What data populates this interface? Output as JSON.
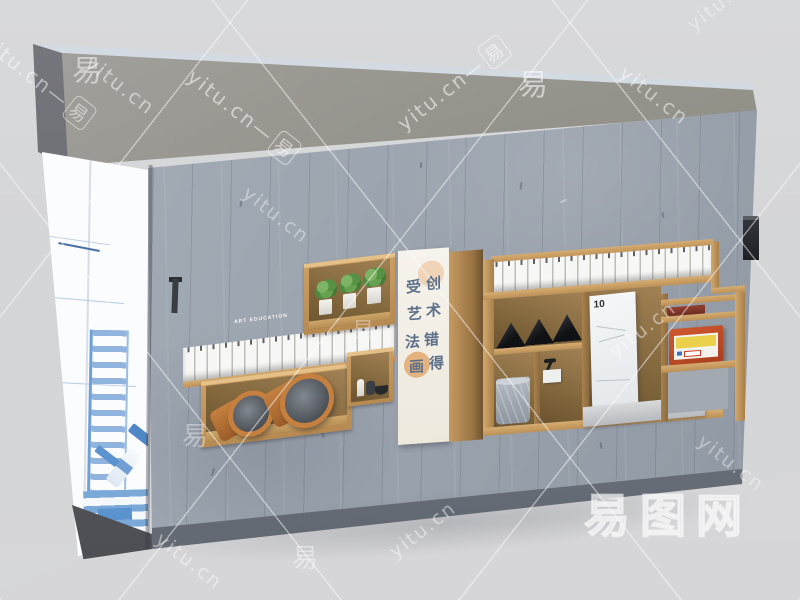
{
  "watermark": {
    "site": "yitu.cn",
    "char": "易",
    "dash": "—",
    "logo": "易图网",
    "tiles": [
      {
        "t": "combo",
        "x": -15,
        "y": 25,
        "rot": 38,
        "s": 20,
        "o": 0.5
      },
      {
        "t": "site",
        "x": 88,
        "y": 48,
        "rot": 38,
        "s": 20,
        "o": 0.5
      },
      {
        "t": "combo",
        "x": 190,
        "y": 60,
        "rot": 38,
        "s": 20,
        "o": 0.55
      },
      {
        "t": "combo",
        "x": 400,
        "y": 112,
        "rot": -38,
        "s": 20,
        "o": 0.55
      },
      {
        "t": "site",
        "x": 622,
        "y": 58,
        "rot": 38,
        "s": 20,
        "o": 0.5
      },
      {
        "t": "site",
        "x": 690,
        "y": 16,
        "rot": -38,
        "s": 19,
        "o": 0.4
      },
      {
        "t": "char",
        "x": 72,
        "y": 46,
        "rot": 0,
        "s": 30,
        "o": 0.5
      },
      {
        "t": "char",
        "x": 518,
        "y": 60,
        "rot": 0,
        "s": 30,
        "o": 0.55
      },
      {
        "t": "site",
        "x": 245,
        "y": 180,
        "rot": 38,
        "s": 19,
        "o": 0.4
      },
      {
        "t": "char",
        "x": 352,
        "y": 313,
        "rot": 0,
        "s": 22,
        "o": 0.35
      },
      {
        "t": "site",
        "x": 612,
        "y": 343,
        "rot": -38,
        "s": 19,
        "o": 0.45
      },
      {
        "t": "char",
        "x": 182,
        "y": 416,
        "rot": 0,
        "s": 26,
        "o": 0.4
      },
      {
        "t": "site",
        "x": 700,
        "y": 428,
        "rot": 38,
        "s": 19,
        "o": 0.4
      },
      {
        "t": "site",
        "x": 158,
        "y": 526,
        "rot": 38,
        "s": 19,
        "o": 0.45
      },
      {
        "t": "char",
        "x": 292,
        "y": 538,
        "rot": 0,
        "s": 26,
        "o": 0.45
      },
      {
        "t": "site",
        "x": 392,
        "y": 543,
        "rot": -38,
        "s": 19,
        "o": 0.45
      }
    ]
  },
  "banner": {
    "left_col": [
      "受",
      "艺",
      "法",
      "画"
    ],
    "right_col": [
      "创",
      "术",
      "错",
      "得"
    ]
  },
  "captions": {
    "left_shelf": "ART EDUCATION",
    "right_shelf": "ART EDUCATION"
  },
  "panel": {
    "doodle": "10"
  },
  "colors": {
    "wall": "#99a2ac",
    "wood": "#c99b60",
    "wood_shadow": "#8d7147",
    "slab_top": "#ccd3db",
    "slab_front": "#92908a",
    "plant_green": "#5f9e4e",
    "terracotta": "#c5803f",
    "pyramid_black": "#17181c",
    "red_box": "#c4502a",
    "label_yellow": "#ead04b",
    "banner_bg": "#f4f1e8",
    "banner_ink": "#5d7089",
    "sketch_blue": "#6f9fd4",
    "watermark": "#ffffff"
  }
}
